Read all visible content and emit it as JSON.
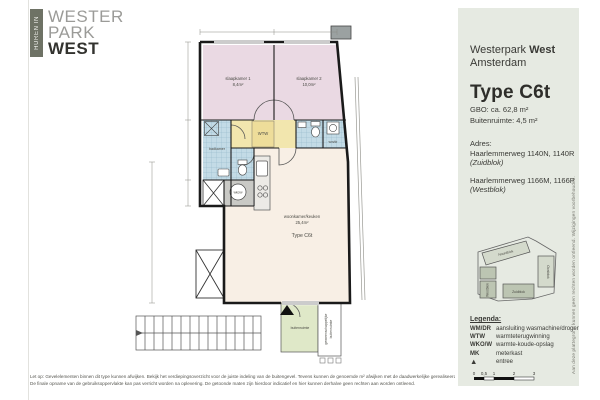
{
  "logo": {
    "tab": "HUREN IN",
    "line1": "WESTER",
    "line2": "PARK",
    "line3": "WEST"
  },
  "panel": {
    "project": "Westerpark",
    "project_bold": "West",
    "city": "Amsterdam",
    "type_title": "Type C6t",
    "gbo": "GBO: ca. 62,8 m²",
    "buitenruimte": "Buitenruimte: 4,5 m²",
    "adres_label": "Adres:",
    "adres1": "Haarlemmerweg 1140N, 1140R",
    "adres1_block": "(Zuidblok)",
    "adres2": "Haarlemmerweg 1166M, 1166P",
    "adres2_block": "(Westblok)",
    "siteplan_blocks": [
      "Noordblok",
      "Oostblok",
      "Westblok",
      "Zuidblok"
    ],
    "legend": {
      "title": "Legenda:",
      "items": [
        {
          "key": "WM/DR",
          "label": "aansluiting wasmachine/droger"
        },
        {
          "key": "WTW",
          "label": "warmteterugwinning"
        },
        {
          "key": "WKO/W",
          "label": "warmte-koude-opslag"
        },
        {
          "key": "MK",
          "label": "meterkast"
        },
        {
          "key": "▲",
          "label": "entree"
        }
      ]
    },
    "scalebar_labels": [
      "0",
      "0,5",
      "1",
      "2",
      "3"
    ],
    "side_note": "Aan deze plattegrond kunnen geen rechten worden ontleend. Wijzigingen voorbehouden."
  },
  "plan": {
    "bedroom1": {
      "name": "slaapkamer 1",
      "area": "8,4m²"
    },
    "bedroom2": {
      "name": "slaapkamer 2",
      "area": "10,0m²"
    },
    "bathroom": {
      "name": "badkamer"
    },
    "hall_unit": "WTW",
    "wash_unit": "wm/dr",
    "wko_unit": "wko/w",
    "living": {
      "name": "woonkamer/keuken",
      "area": "25,4m²",
      "type": "Type C6t"
    },
    "balcony": {
      "name": "buitenruimte"
    },
    "gallery_line1": "gemeenschappelijke",
    "gallery_line2": "buitenruimte"
  },
  "footer": {
    "line1": "Let op: Gevelelementen binnen dit type kunnen afwijken. Bekijk het verdiepingsoverzicht voor de juiste indeling van de buitengevel. Tevens kunnen de genoemde m² afwijken met de daadwerkelijke gerealiseerde oppervlakten.",
    "line2": "De finale opname van de gebruiksoppervlakte kan pas verricht worden na oplevering. De getoonde maten zijn hierdoor indicatief en hier kunnen derhalve geen rechten aan worden ontleend."
  },
  "colors": {
    "panel_bg": "#e6eae2",
    "logo_tab": "#6e7265",
    "bedroom_pink": "#ead9e3",
    "wet_room_blue": "#c3dbe6",
    "hall_yellow": "#f2e6ae",
    "living_cream": "#f8efe5",
    "balcony_green": "#dfe8c8",
    "wall_black": "#1a1a1a"
  }
}
